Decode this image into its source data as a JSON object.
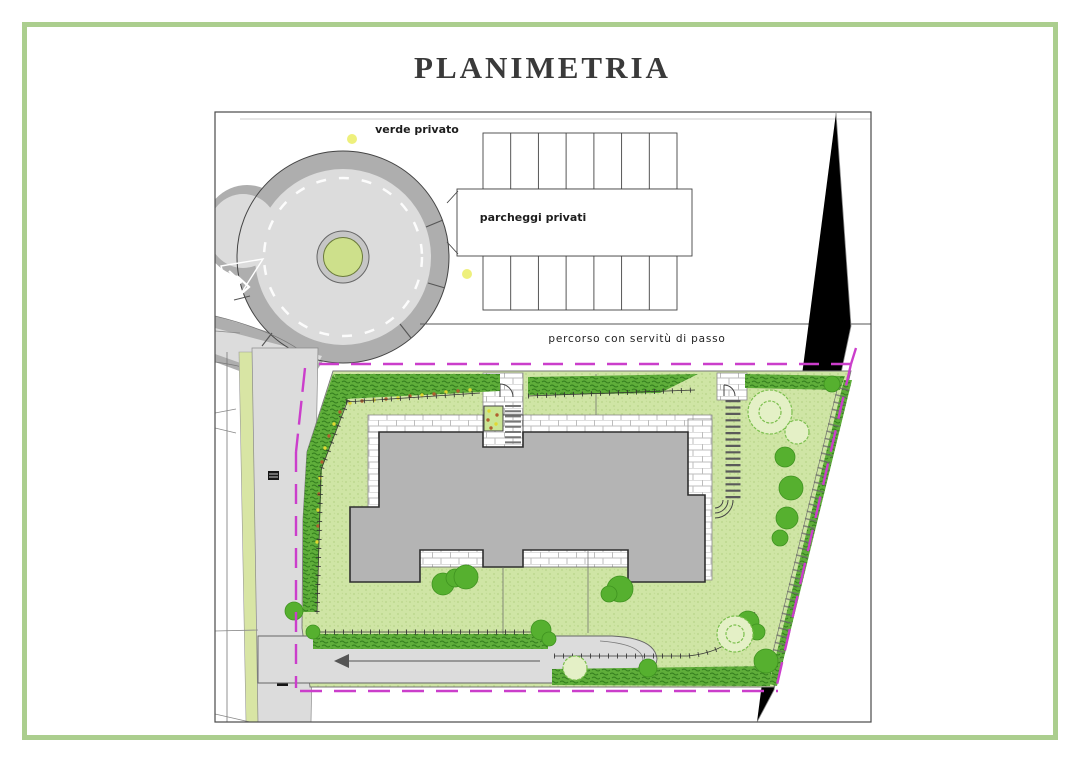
{
  "page": {
    "title": "PLANIMETRIA"
  },
  "plan": {
    "labels": {
      "verde_privato": "verde privato",
      "parcheggi_privati": "parcheggi privati",
      "percorso": "percorso con servitù di passo"
    },
    "colors": {
      "border_green": "#abce8e",
      "title_text": "#3a3a3a",
      "road": "#dcdcdc",
      "curb": "#aeaeae",
      "island_ring": "#c6c6c6",
      "island_green": "#cde08b",
      "lawn": "#cfe5a5",
      "verge": "#d8e5a4",
      "building": "#b4b4b4",
      "hedge": "#5fae3a",
      "tree_solid": "#56b02f",
      "tree_pale": "#e4f0c6",
      "tree_outline": "#7cbf4e",
      "boundary_magenta": "#cb3ecb",
      "lamp_yellow": "#eef07c",
      "flower_yellow": "#e0d832",
      "flower_red": "#b05f2e"
    }
  }
}
